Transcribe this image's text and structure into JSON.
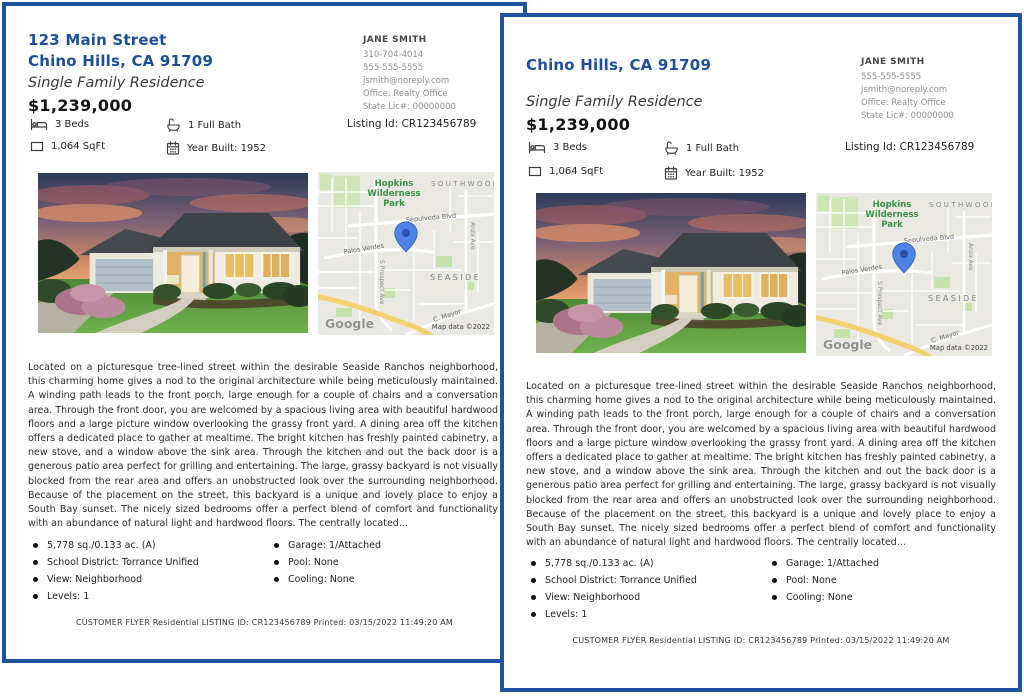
{
  "flyers": [
    {
      "address_line1": "123 Main Street",
      "address_line2": "Chino Hills, CA 91709",
      "property_type": "Single Family Residence",
      "price": "$1,239,000",
      "agent": {
        "name": "JANE SMITH",
        "lines": [
          "310-704-4014",
          "555-555-5555",
          "jsmith@noreply.com",
          "Office: Realty Office",
          "State Lic#:  00000000"
        ]
      },
      "listing_id": "Listing Id: CR123456789",
      "features": {
        "beds": "3 Beds",
        "bath": "1 Full Bath",
        "sqft": "1,064 SqFt",
        "year_built": "Year Built: 1952"
      },
      "description": "Located on a picturesque tree-lined street within the desirable Seaside Ranchos neighborhood, this charming home gives a nod to the original architecture while being meticulously maintained. A winding path leads to the front porch, large enough for a couple of chairs and a conversation area. Through the front door, you are welcomed by a spacious living area with beautiful hardwood floors and a large picture window overlooking the grassy front yard. A dining area off the kitchen offers a dedicated place to gather at mealtime. The bright kitchen has freshly painted cabinetry, a new stove, and a window above the sink area. Through the kitchen and out the back door is a generous patio area perfect for grilling and entertaining. The large, grassy backyard is not visually blocked from the rear area and offers an unobstructed look over the surrounding neighborhood. Because of the placement on the street, this backyard is a unique and lovely place to enjoy a South Bay sunset. The nicely sized bedrooms offer a perfect blend of comfort and functionality with an abundance of natural light and hardwood floors. The centrally located...",
      "bullets_left": [
        "5,778 sq./0.133 ac. (A)",
        "School District: Torrance Unified",
        "View: Neighborhood",
        "Levels: 1"
      ],
      "bullets_right": [
        "Garage: 1/Attached",
        "Pool: None",
        "Cooling: None"
      ],
      "footer": "CUSTOMER FLYER Residential  LISTING ID: CR123456789 Printed: 03/15/2022 11:49:20 AM"
    },
    {
      "address_line2": "Chino Hills, CA 91709",
      "property_type": "Single Family Residence",
      "price": "$1,239,000",
      "agent": {
        "name": "JANE SMITH",
        "lines": [
          "555-555-5555",
          "jsmith@noreply.com",
          "Office: Realty Office",
          "State Lic#:  00000000"
        ]
      },
      "listing_id": "Listing Id: CR123456789",
      "features": {
        "beds": "3 Beds",
        "bath": "1 Full Bath",
        "sqft": "1,064 SqFt",
        "year_built": "Year Built: 1952"
      },
      "description": "Located on a picturesque tree-lined street within the desirable Seaside Ranchos neighborhood, this charming home gives a nod to the original architecture while being meticulously maintained. A winding path leads to the front porch, large enough for a couple of chairs and a conversation area. Through the front door, you are welcomed by a spacious living area with beautiful hardwood floors and a large picture window overlooking the grassy front yard. A dining area off the kitchen offers a dedicated place to gather at mealtime. The bright kitchen has freshly painted cabinetry, a new stove, and a window above the sink area. Through the kitchen and out the back door is a generous patio area perfect for grilling and entertaining. The large, grassy backyard is not visually blocked from the rear area and offers an unobstructed look over the surrounding neighborhood. Because of the placement on the street, this backyard is a unique and lovely place to enjoy a South Bay sunset. The nicely sized bedrooms offer a perfect blend of comfort and functionality with an abundance of natural light and hardwood floors. The centrally located...",
      "bullets_left": [
        "5,778 sq./0.133 ac. (A)",
        "School District: Torrance Unified",
        "View: Neighborhood",
        "Levels: 1"
      ],
      "bullets_right": [
        "Garage: 1/Attached",
        "Pool: None",
        "Cooling: None"
      ],
      "footer": "CUSTOMER FLYER Residential  LISTING ID: CR123456789 Printed: 03/15/2022 11:49:20 AM"
    }
  ],
  "map": {
    "park_line1": "Hopkins",
    "park_line2": "Wilderness",
    "park_line3": "Park",
    "district_top": "SOUTHWOOD",
    "district_center": "SEASIDE",
    "street_sepulveda": "Sepulveda Blvd",
    "street_palos_verdes": "Palos Verdes",
    "street_prospect": "S Prospect Ave",
    "street_anza": "Anza Ave",
    "street_mayor": "C. Mayor",
    "logo": "Google",
    "attribution": "Map data ©2022"
  },
  "colors": {
    "border_blue": "#1f53a0",
    "title_blue": "#1b4f9c",
    "map_park_green": "#3a9243",
    "map_pin_blue": "#4f83e8"
  }
}
